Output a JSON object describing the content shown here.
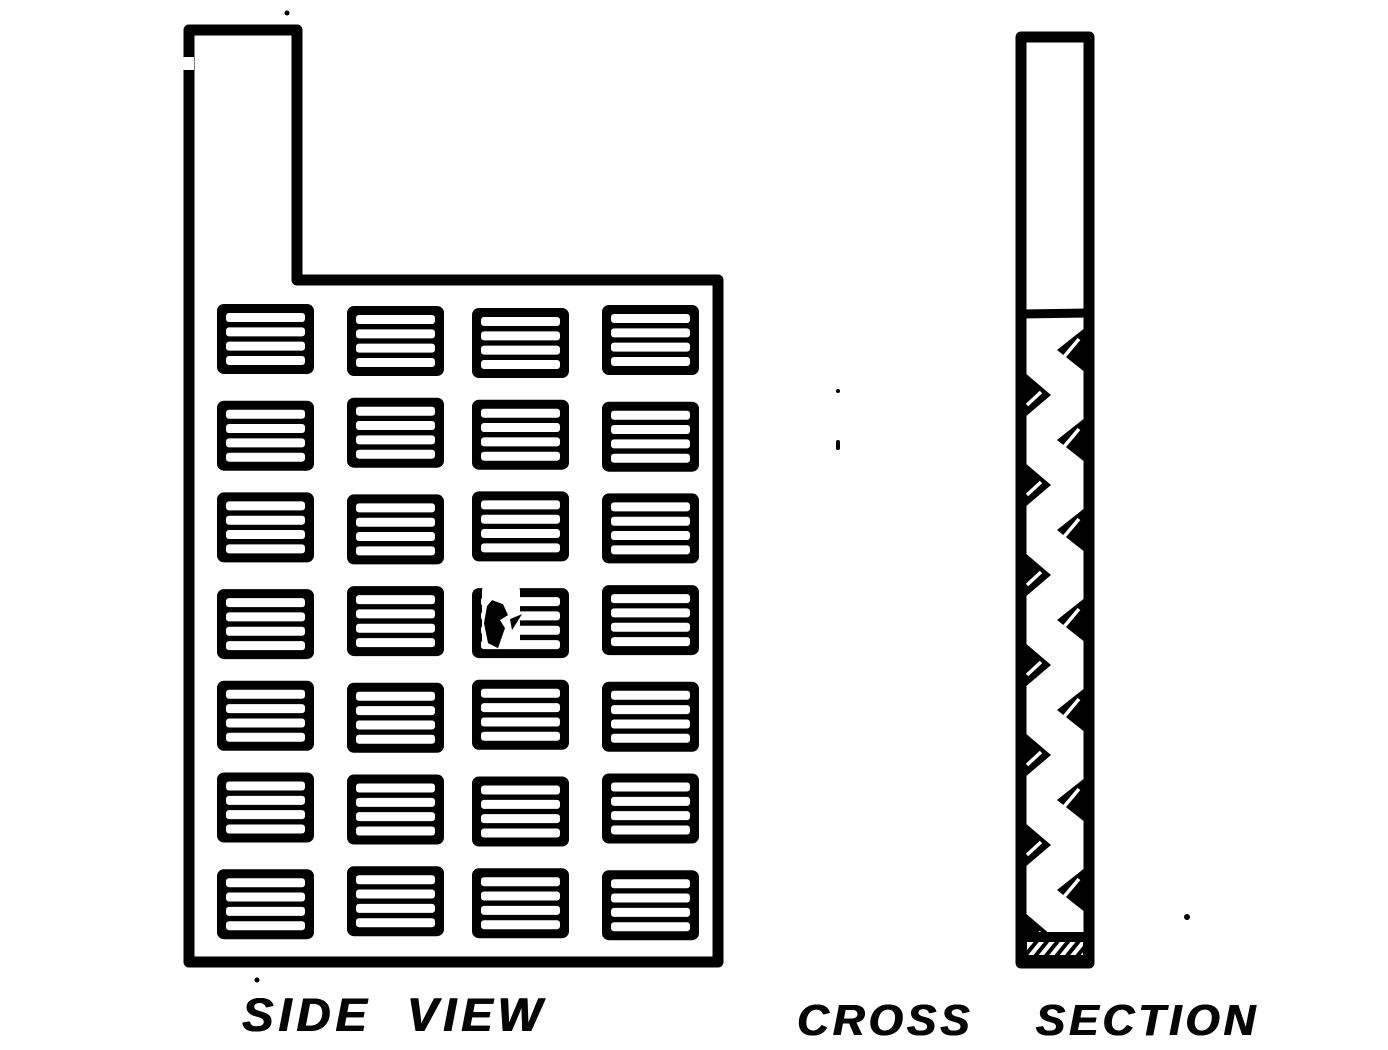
{
  "page": {
    "background_color": "#ffffff",
    "ink_color": "#000000"
  },
  "side_view": {
    "label": "SIDE VIEW",
    "grid_rows": 7,
    "grid_columns": 4,
    "stripes_per_cell": 4,
    "has_top_lug": true,
    "print_defect_cell": {
      "row": 4,
      "column": 3
    }
  },
  "cross_section": {
    "label": "CROSS SECTION",
    "zigzag_triangles_right": 7,
    "zigzag_triangles_left": 7,
    "has_divider_line": true,
    "hatched_base": true
  }
}
